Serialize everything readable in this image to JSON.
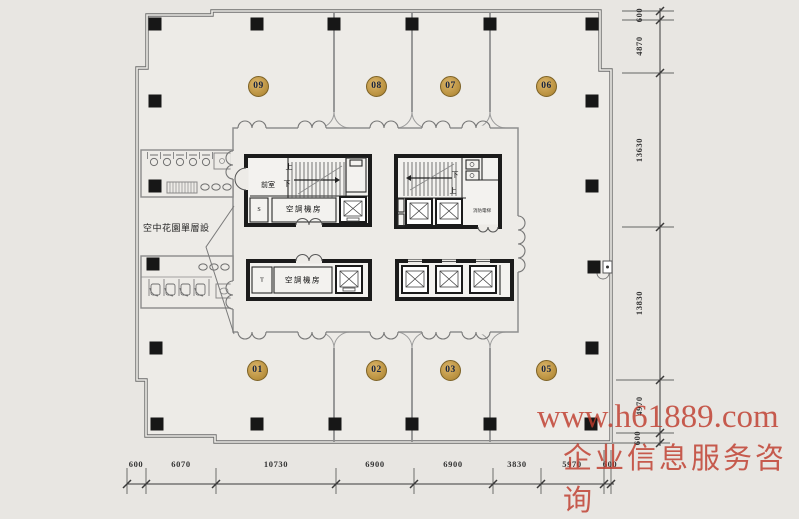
{
  "rooms": [
    {
      "label": "09"
    },
    {
      "label": "08"
    },
    {
      "label": "07"
    },
    {
      "label": "06"
    },
    {
      "label": "01"
    },
    {
      "label": "02"
    },
    {
      "label": "03"
    },
    {
      "label": "05"
    }
  ],
  "core": {
    "front_room": "前室",
    "stair_up": "上",
    "stair_down": "下",
    "ac_room": "空調機房",
    "room_t": "T",
    "room_s": "S",
    "fire_elevator": "消防電梯"
  },
  "annotations": {
    "sky_garden": "空中花園單層設"
  },
  "dimensions": {
    "right": [
      "600",
      "4870",
      "13630",
      "13830",
      "4970",
      "600"
    ],
    "bottom": [
      "600",
      "6070",
      "10730",
      "6900",
      "6900",
      "3830",
      "5970",
      "600"
    ]
  },
  "watermark": {
    "line1": "www.h61889.com",
    "line2": "企业信息服务咨询",
    "color": "#be3a2c"
  },
  "colors": {
    "background": "#e8e6e2",
    "floor": "#edebe7",
    "wall": "#6b6b6b",
    "core_wall": "#1b1b1b",
    "badge": "#c59c4e"
  }
}
